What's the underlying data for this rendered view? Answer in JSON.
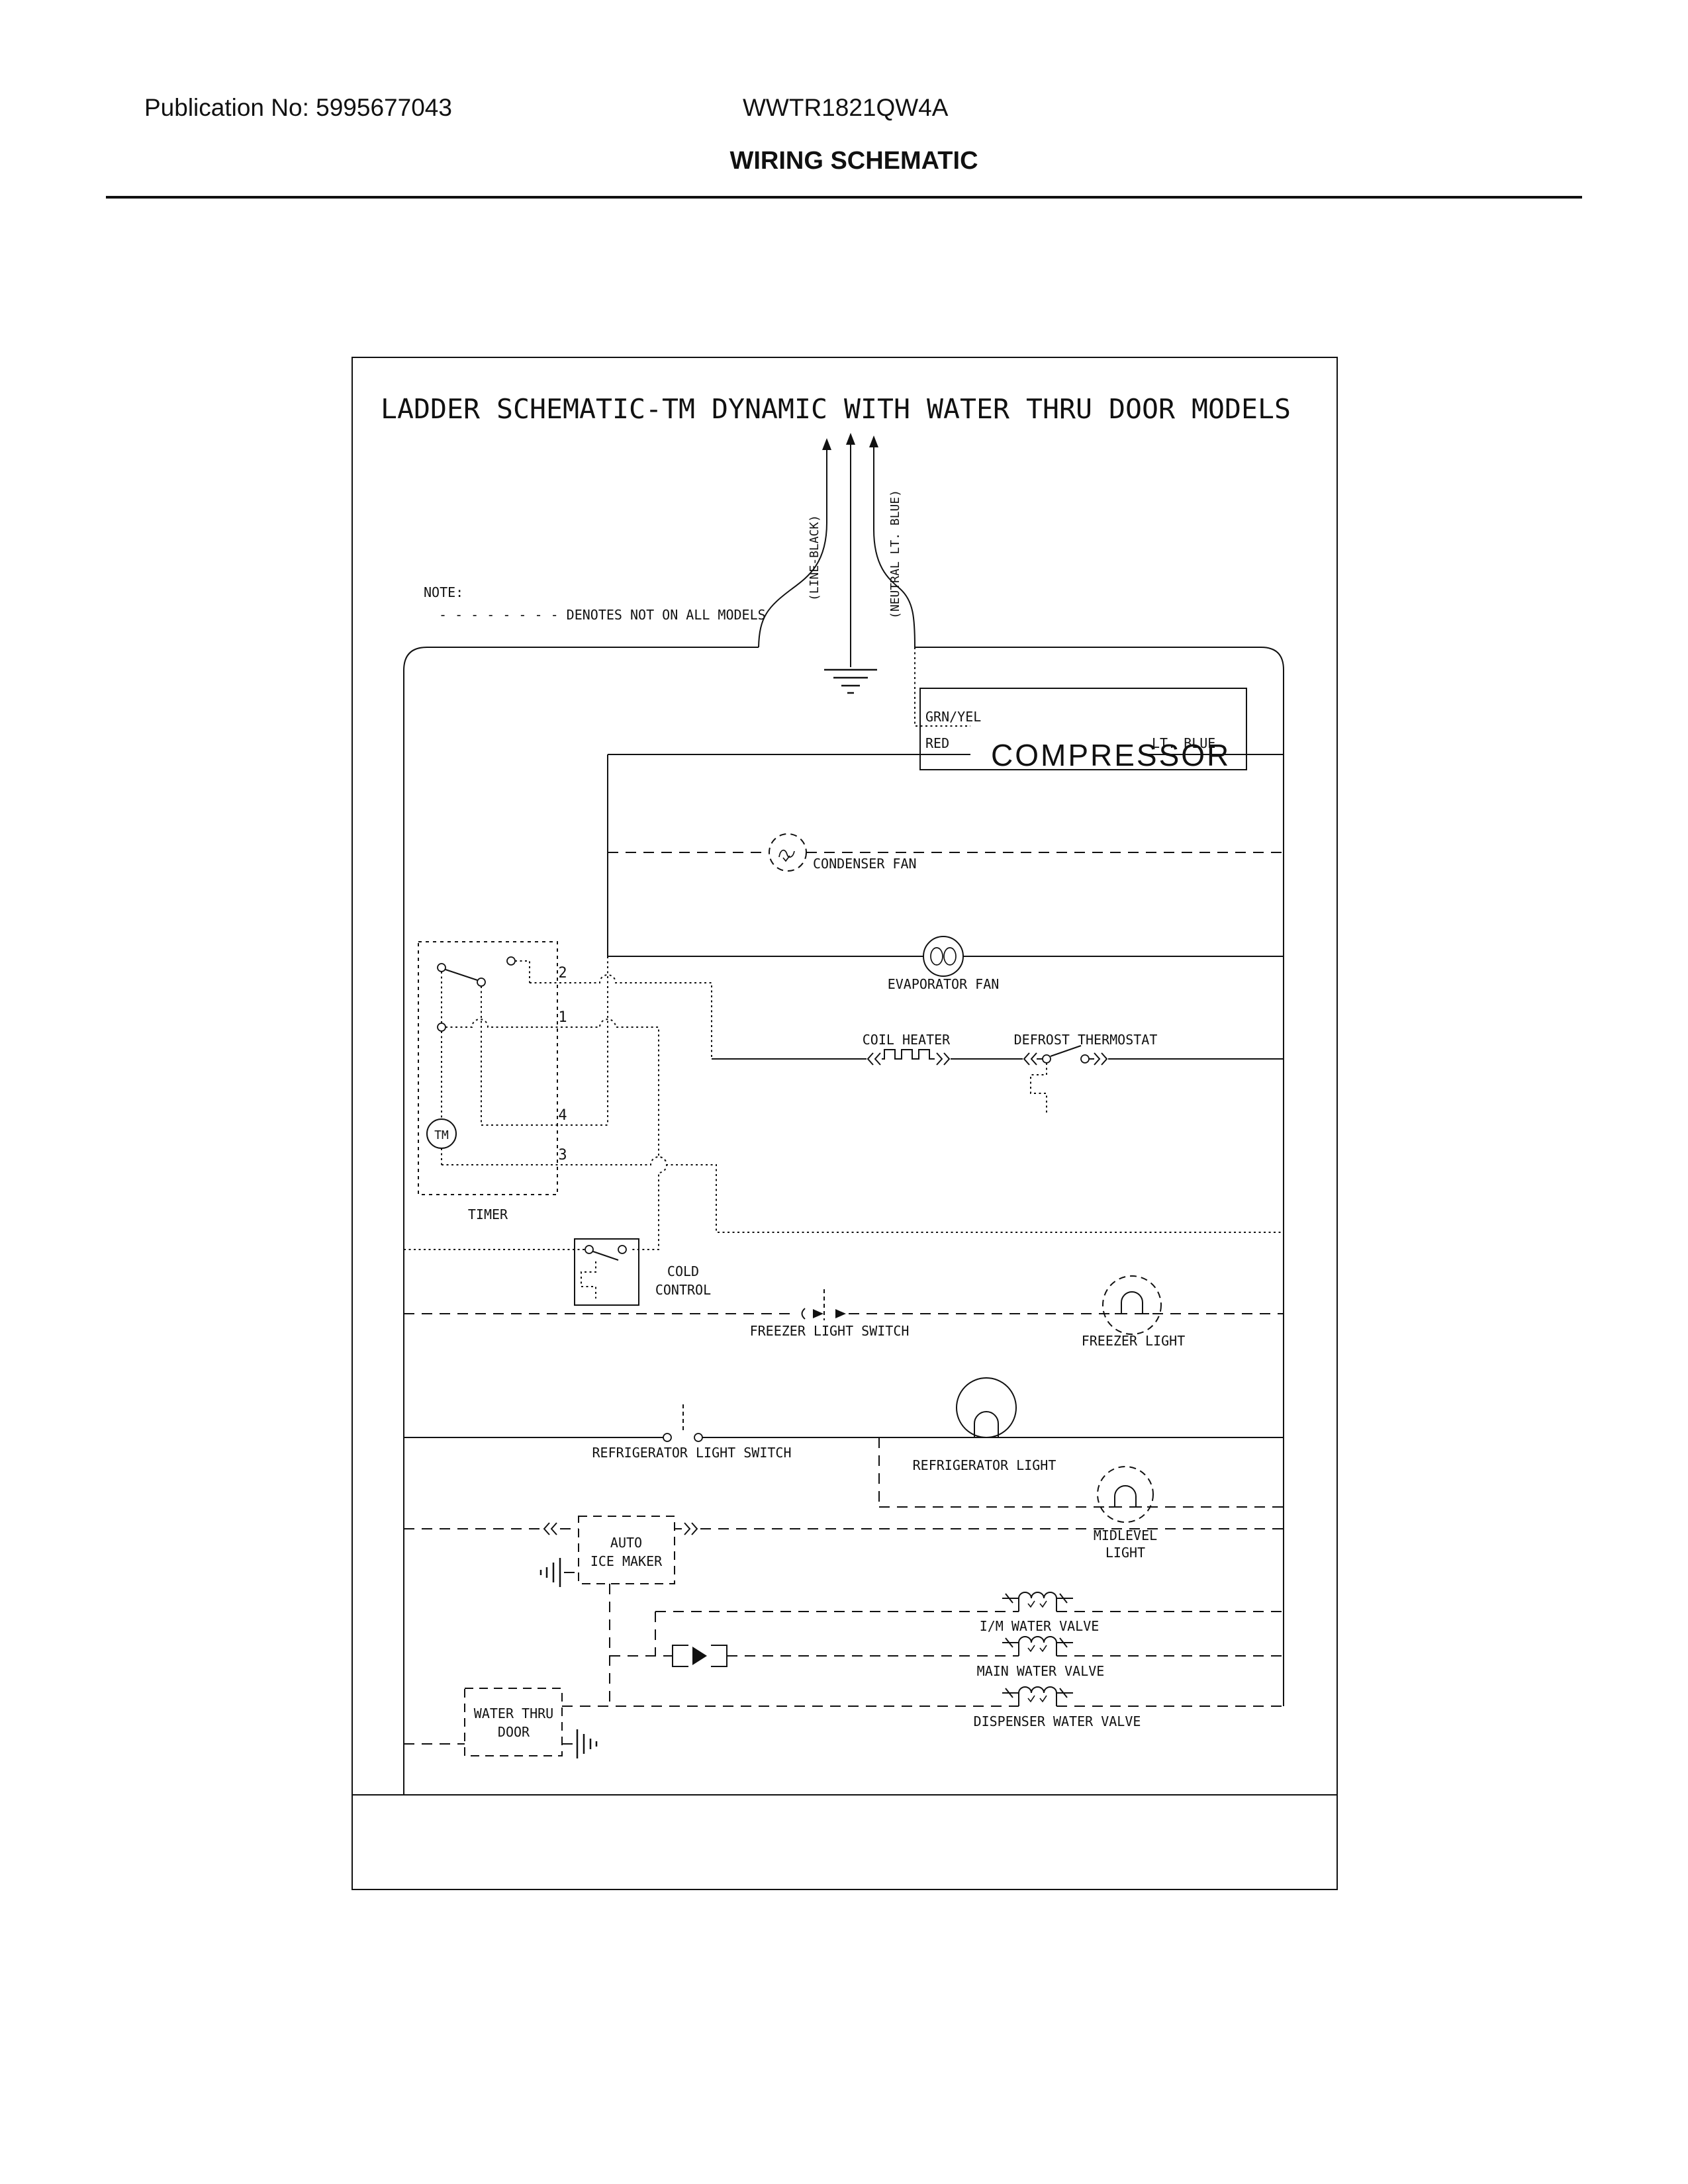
{
  "header": {
    "publication": "Publication No: 5995677043",
    "model": "WWTR1821QW4A",
    "page_title": "WIRING SCHEMATIC"
  },
  "schematic": {
    "title": "LADDER SCHEMATIC-TM DYNAMIC WITH WATER THRU DOOR MODELS",
    "note_heading": "NOTE:",
    "note_text": "- - - - - - - - DENOTES NOT ON ALL MODELS",
    "power": {
      "line": "(LINE-BLACK)",
      "neutral": "(NEUTRAL LT. BLUE)"
    },
    "compressor": {
      "label": "COMPRESSOR",
      "grn_yel": "GRN/YEL",
      "red": "RED",
      "lt_blue": "LT. BLUE"
    },
    "labels": {
      "condenser_fan": "CONDENSER FAN",
      "evaporator_fan": "EVAPORATOR FAN",
      "coil_heater": "COIL HEATER",
      "defrost_thermostat": "DEFROST THERMOSTAT",
      "timer": "TIMER",
      "timer_motor": "TM",
      "terminal_2": "2",
      "terminal_1": "1",
      "terminal_4": "4",
      "terminal_3": "3",
      "cold_control_1": "COLD",
      "cold_control_2": "CONTROL",
      "freezer_light_switch": "FREEZER LIGHT SWITCH",
      "freezer_light": "FREEZER LIGHT",
      "refrigerator_light_switch": "REFRIGERATOR LIGHT SWITCH",
      "refrigerator_light": "REFRIGERATOR LIGHT",
      "midlevel_light_1": "MIDLEVEL",
      "midlevel_light_2": "LIGHT",
      "auto_ice_maker_1": "AUTO",
      "auto_ice_maker_2": "ICE MAKER",
      "im_water_valve": "I/M WATER VALVE",
      "main_water_valve": "MAIN WATER VALVE",
      "dispenser_water_valve": "DISPENSER WATER VALVE",
      "water_thru_door_1": "WATER THRU",
      "water_thru_door_2": "DOOR"
    }
  }
}
